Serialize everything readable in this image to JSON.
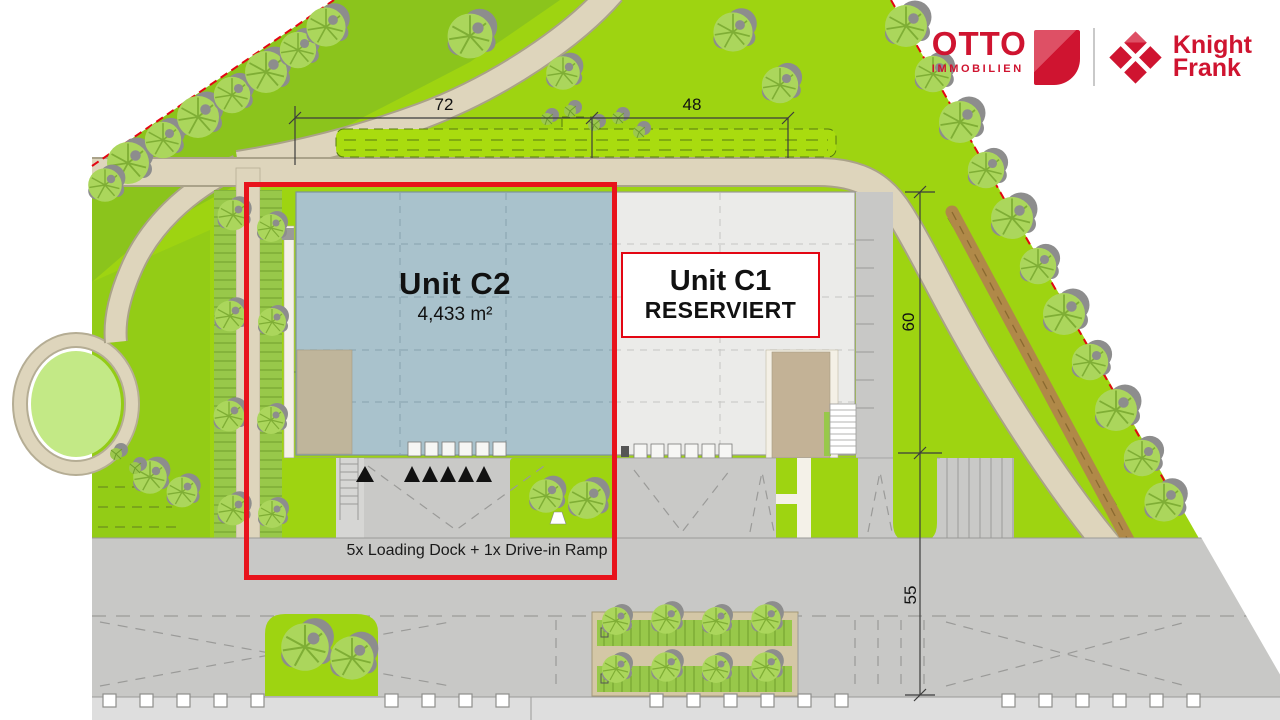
{
  "header": {
    "otto": {
      "title": "OTTO",
      "subtitle": "IMMOBILIEN"
    },
    "knight_frank": {
      "line1": "Knight",
      "line2": "Frank"
    }
  },
  "plan": {
    "unit_c2": {
      "title": "Unit C2",
      "area": "4,433 m²"
    },
    "unit_c1": {
      "title": "Unit C1",
      "status": "RESERVIERT"
    },
    "loading_note": "5x Loading Dock + 1x Drive-in Ramp",
    "dimensions": {
      "width_c2": "72",
      "width_c1": "48",
      "depth_building": "60",
      "depth_yard": "55"
    },
    "colors": {
      "highlight_red": "#e8131c",
      "boundary_red": "#e30613",
      "unit_c2_fill": "#a9c2cc",
      "unit_c1_fill": "#ebebe9",
      "grass_green": "#9ed411",
      "logo_red": "#cf1430"
    }
  }
}
